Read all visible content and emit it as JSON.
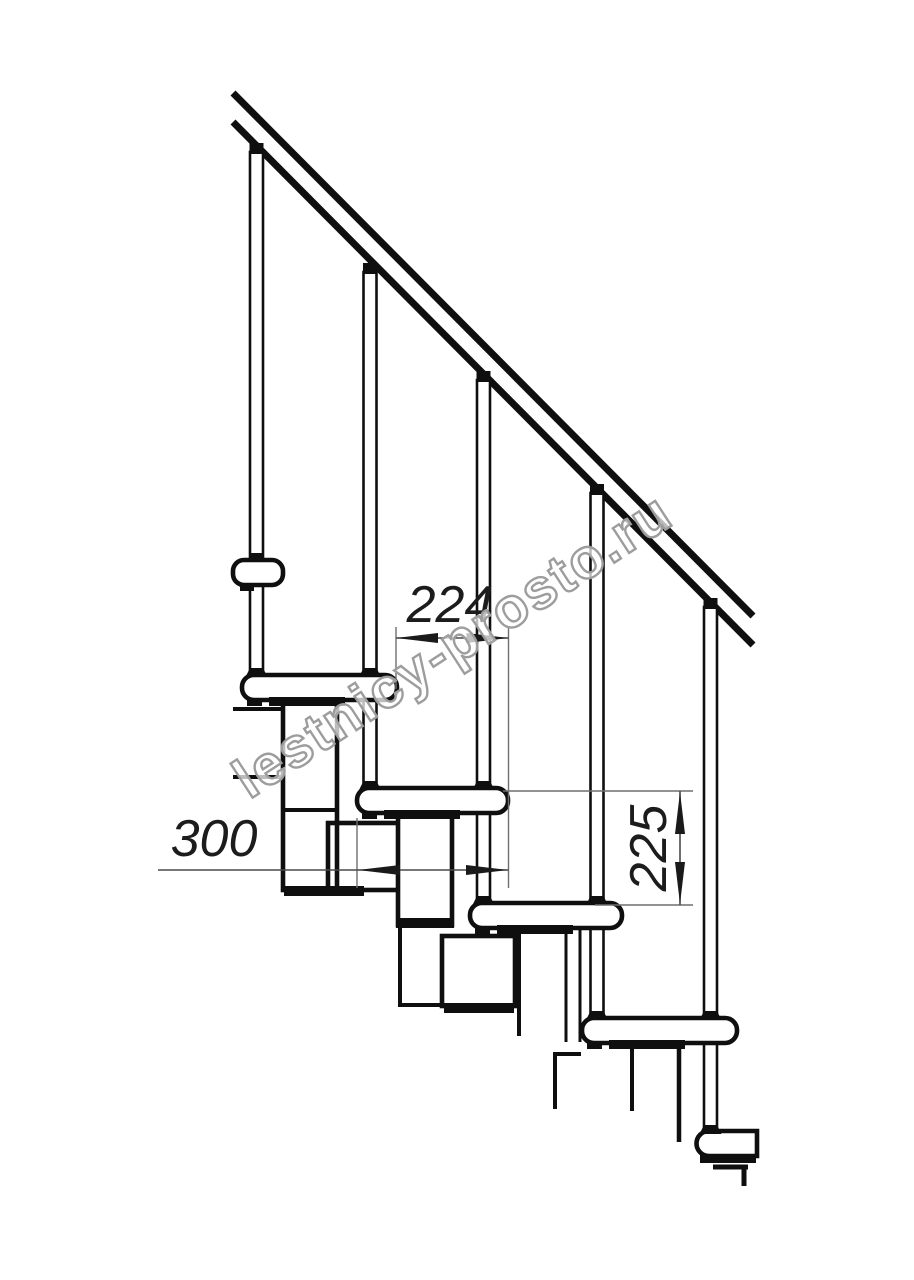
{
  "page": {
    "background": "#ffffff",
    "width": 914,
    "height": 1280
  },
  "drawing": {
    "type": "technical-line-drawing",
    "subject": "modular staircase side elevation",
    "tread_count": 6,
    "baluster_count": 5,
    "handrail": "diagonal double line, upper-left to lower-right"
  },
  "dimensions": {
    "going": {
      "label": "224",
      "orientation": "horizontal"
    },
    "tread_depth": {
      "label": "300",
      "orientation": "horizontal"
    },
    "rise": {
      "label": "225",
      "orientation": "vertical"
    }
  },
  "watermark": {
    "text": "lestnicy-prosto.ru"
  },
  "colors": {
    "line": "#0f0f0f",
    "dim_line": "#4a4a4a",
    "ext_line": "#6f6f6f",
    "text": "#1c1c1c",
    "watermark_stroke": "#9d9d9d",
    "background": "#ffffff"
  }
}
